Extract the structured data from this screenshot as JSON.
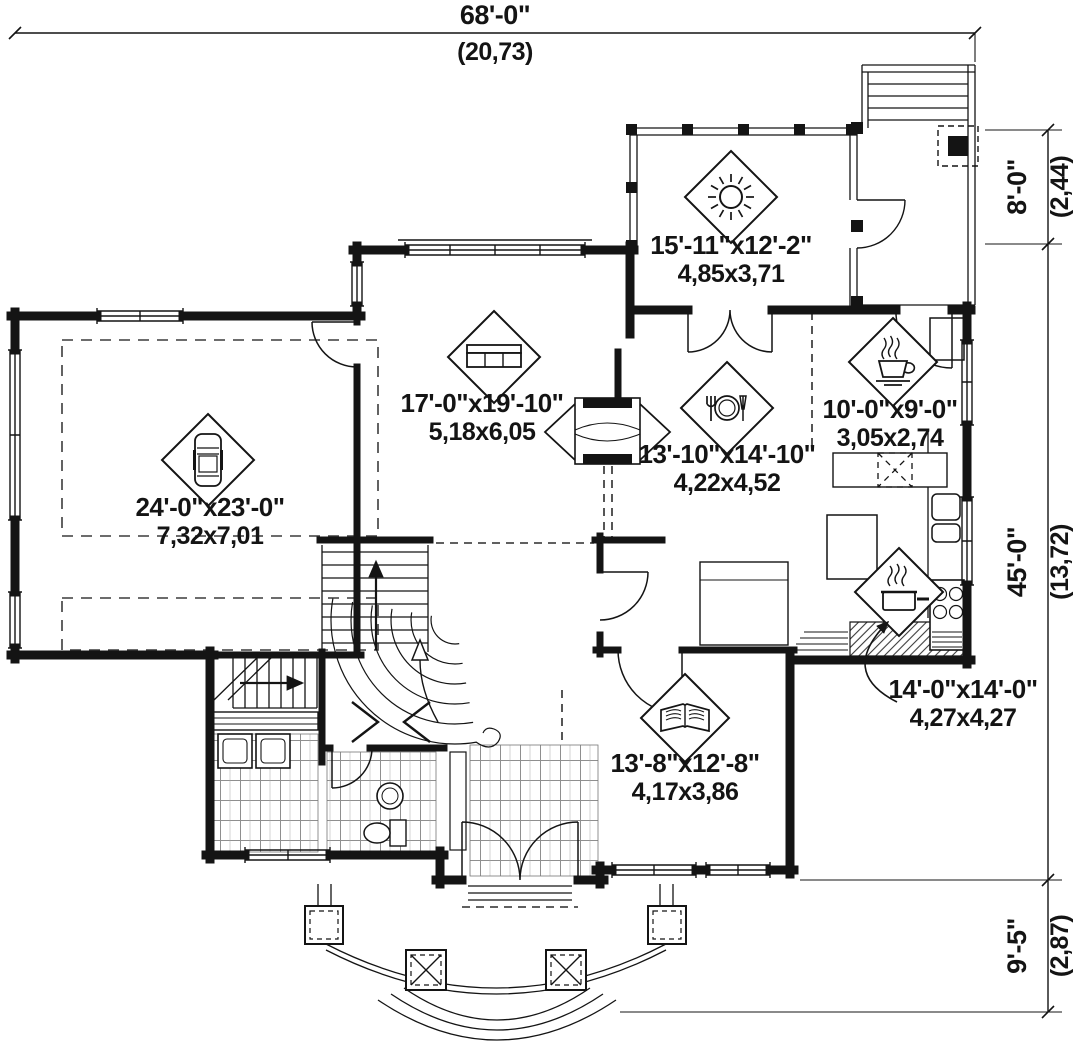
{
  "dimensions": {
    "overall_width": {
      "imperial": "68'-0\"",
      "metric": "(20,73)"
    },
    "deck_depth": {
      "imperial": "8'-0\"",
      "metric": "(2,44)"
    },
    "house_depth": {
      "imperial": "45'-0\"",
      "metric": "(13,72)"
    },
    "porch_depth": {
      "imperial": "9'-5\"",
      "metric": "(2,87)"
    }
  },
  "rooms": {
    "sunroom": {
      "icon": "sun-icon",
      "imperial": "15'-11\"x12'-2\"",
      "metric": "4,85x3,71"
    },
    "living": {
      "icon": "sofa-icon",
      "imperial": "17'-0\"x19'-10\"",
      "metric": "5,18x6,05"
    },
    "dining": {
      "icon": "dining-icon",
      "imperial": "13'-10\"x14'-10\"",
      "metric": "4,22x4,52"
    },
    "breakfast": {
      "icon": "coffee-icon",
      "imperial": "10'-0\"x9'-0\"",
      "metric": "3,05x2,74"
    },
    "garage": {
      "icon": "car-icon",
      "imperial": "24'-0\"x23'-0\"",
      "metric": "7,32x7,01"
    },
    "kitchen": {
      "icon": "pot-icon",
      "imperial": "14'-0\"x14'-0\"",
      "metric": "4,27x4,27"
    },
    "den": {
      "icon": "book-icon",
      "imperial": "13'-8\"x12'-8\"",
      "metric": "4,17x3,86"
    }
  },
  "colors": {
    "line": "#141414",
    "background": "#ffffff"
  }
}
